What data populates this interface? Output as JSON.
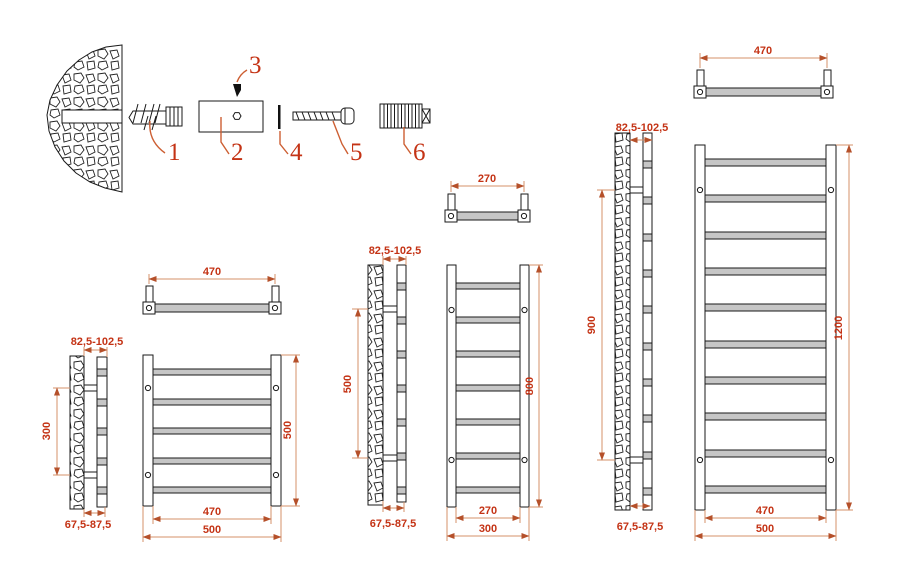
{
  "colors": {
    "line": "#1a1a1a",
    "dimline": "#d49068",
    "dimtext": "#c43315",
    "arrow": "#b5502a",
    "leader": "#cd5f33",
    "rung": "#c6c6c6"
  },
  "hardware": {
    "part_numbers": [
      "1",
      "2",
      "3",
      "4",
      "5",
      "6"
    ]
  },
  "models": {
    "small": {
      "plan_width": "470",
      "wall_offset_top": "82,5-102,5",
      "bracket_spacing": "300",
      "wall_offset_bottom": "67,5-87,5",
      "height": "500",
      "rung_width": "470",
      "overall_width": "500",
      "rung_count": 5
    },
    "medium": {
      "plan_width": "270",
      "wall_offset_top": "82,5-102,5",
      "bracket_spacing": "500",
      "wall_offset_bottom": "67,5-87,5",
      "height": "800",
      "rung_width": "270",
      "overall_width": "300",
      "rung_count": 7
    },
    "large": {
      "plan_width": "470",
      "wall_offset_top": "82,5-102,5",
      "bracket_spacing": "900",
      "wall_offset_bottom": "67,5-87,5",
      "height": "1200",
      "rung_width": "470",
      "overall_width": "500",
      "rung_count": 10
    }
  }
}
